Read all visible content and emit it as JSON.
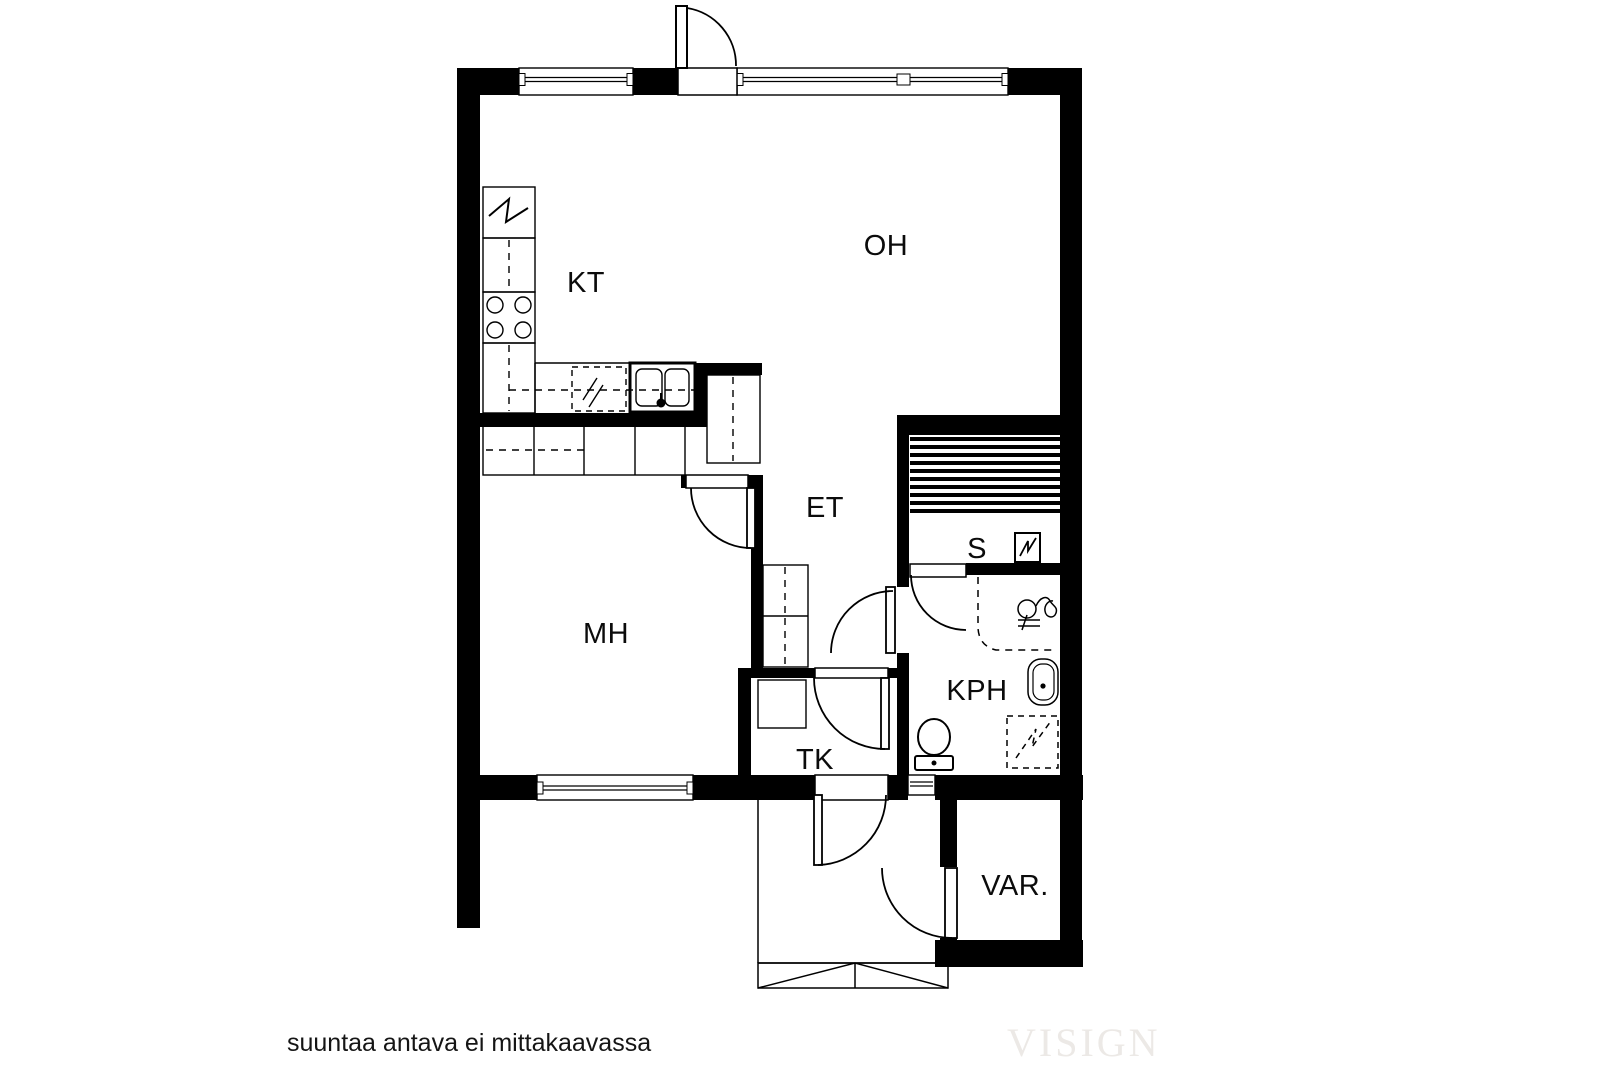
{
  "plan": {
    "type": "floor-plan",
    "rooms": [
      {
        "id": "kt",
        "label": "KT"
      },
      {
        "id": "oh",
        "label": "OH"
      },
      {
        "id": "mh",
        "label": "MH"
      },
      {
        "id": "et",
        "label": "ET"
      },
      {
        "id": "s",
        "label": "S"
      },
      {
        "id": "kph",
        "label": "KPH"
      },
      {
        "id": "tk",
        "label": "TK"
      },
      {
        "id": "var",
        "label": "VAR."
      }
    ],
    "fixtures": [
      "refrigerator",
      "stove",
      "kitchen-sink",
      "dishwasher",
      "counter",
      "wardrobes",
      "sauna-benches",
      "sauna-heater",
      "shower",
      "washbasin",
      "washing-machine",
      "toilet",
      "entrance-steps"
    ],
    "doors": [
      "main-terrace-door",
      "bedroom-door",
      "bathroom-door",
      "sauna-door",
      "vestibule-inner-door",
      "entrance-door",
      "storage-door"
    ],
    "windows": [
      "top-window-left",
      "top-window-right",
      "bedroom-window",
      "bathroom-vent-window"
    ]
  },
  "footer": {
    "note": "suuntaa antava ei mittakaavassa",
    "watermark": "VISIGN"
  },
  "colors": {
    "walls": "#000000",
    "background": "#ffffff",
    "thin_lines": "#000000",
    "label_text": "#0b0b0b",
    "watermark_text": "#ece9e6"
  }
}
